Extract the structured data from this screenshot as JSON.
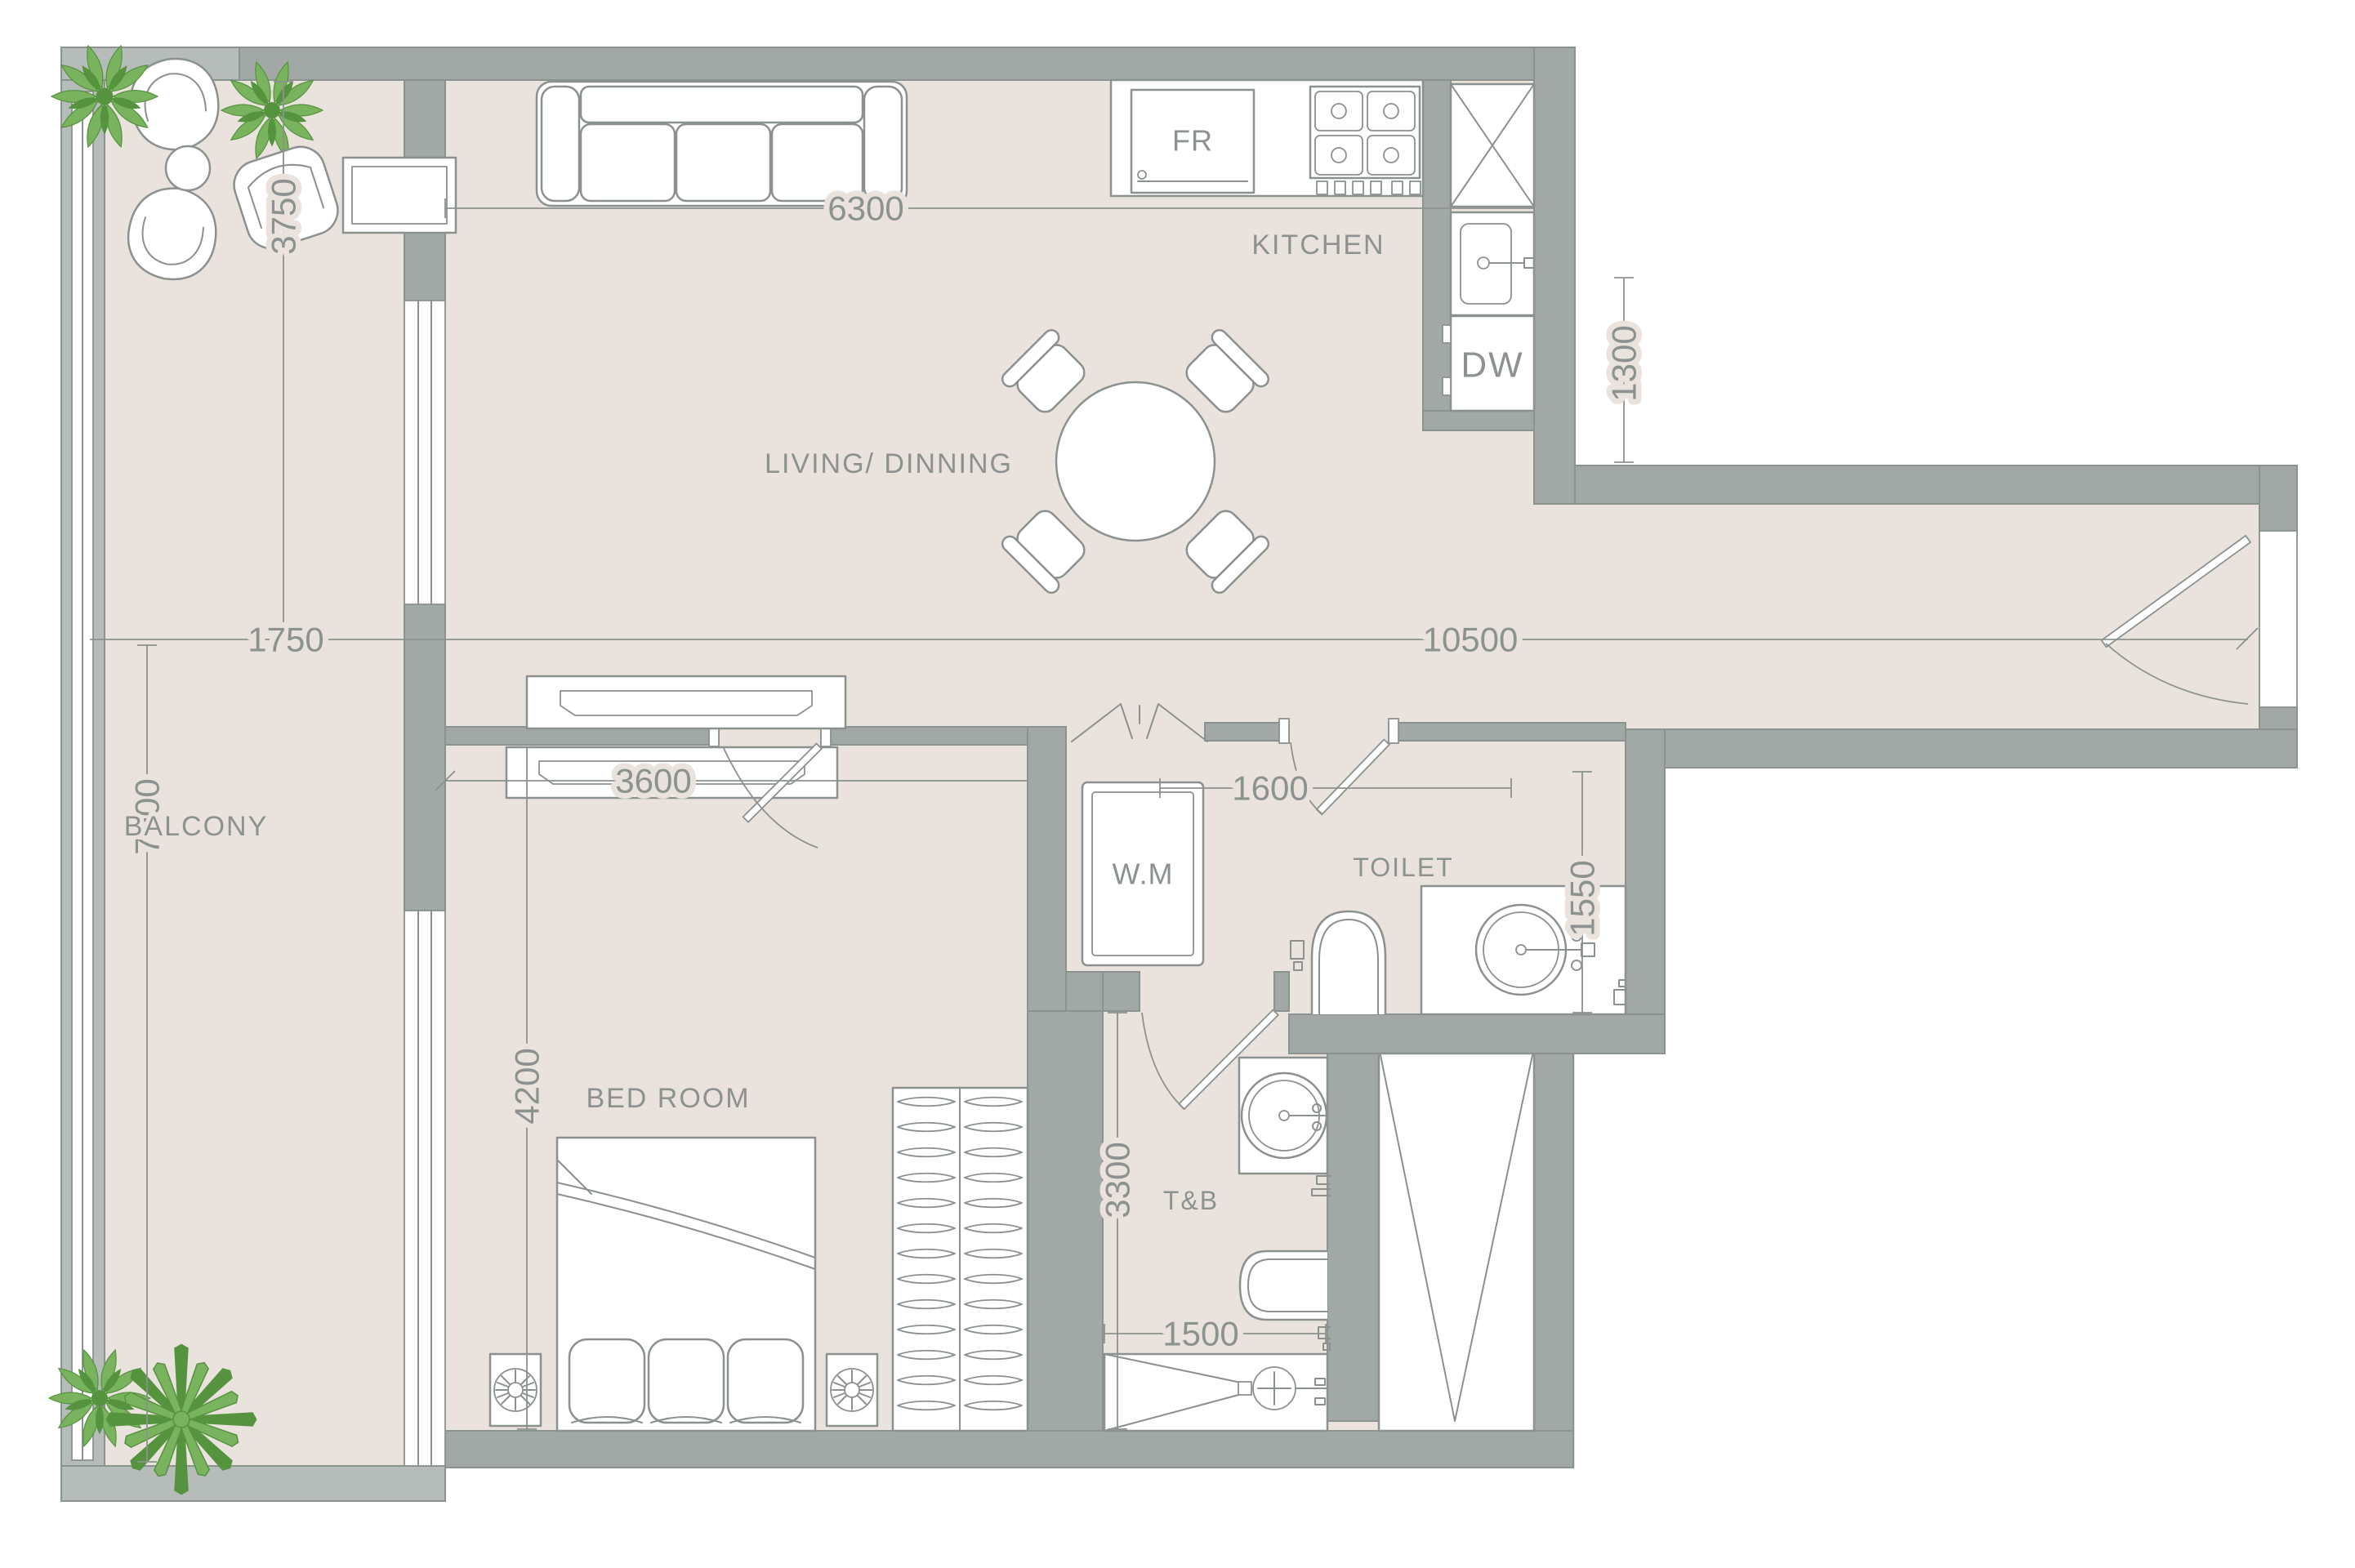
{
  "colors": {
    "wall": "#a1a8a5",
    "wallStroke": "#8b938f",
    "parapet": "#b6bcb9",
    "floor": "#eae3dd",
    "line": "#8b918e",
    "text": "#8c928f",
    "plantLight": "#7ab35e",
    "plantDark": "#55933f",
    "white": "#ffffff"
  },
  "rooms": {
    "balcony": "BALCONY",
    "living": "LIVING/ DINNING",
    "kitchen": "KITCHEN",
    "toilet": "TOILET",
    "bedroom": "BED ROOM",
    "bath": "T&B"
  },
  "appliances": {
    "fridge": "FR",
    "dishwasher": "DW",
    "washer": "W.M"
  },
  "dimensions_mm": {
    "living_width": "6300",
    "overall_width": "10500",
    "balcony_width": "1750",
    "hall_width": "1300",
    "living_depth": "3750",
    "balcony_length": "7900",
    "bedroom_width": "3600",
    "bedroom_depth": "4200",
    "toilet_width": "1600",
    "toilet_depth": "1550",
    "bath_depth": "3300",
    "bath_width": "1500"
  }
}
